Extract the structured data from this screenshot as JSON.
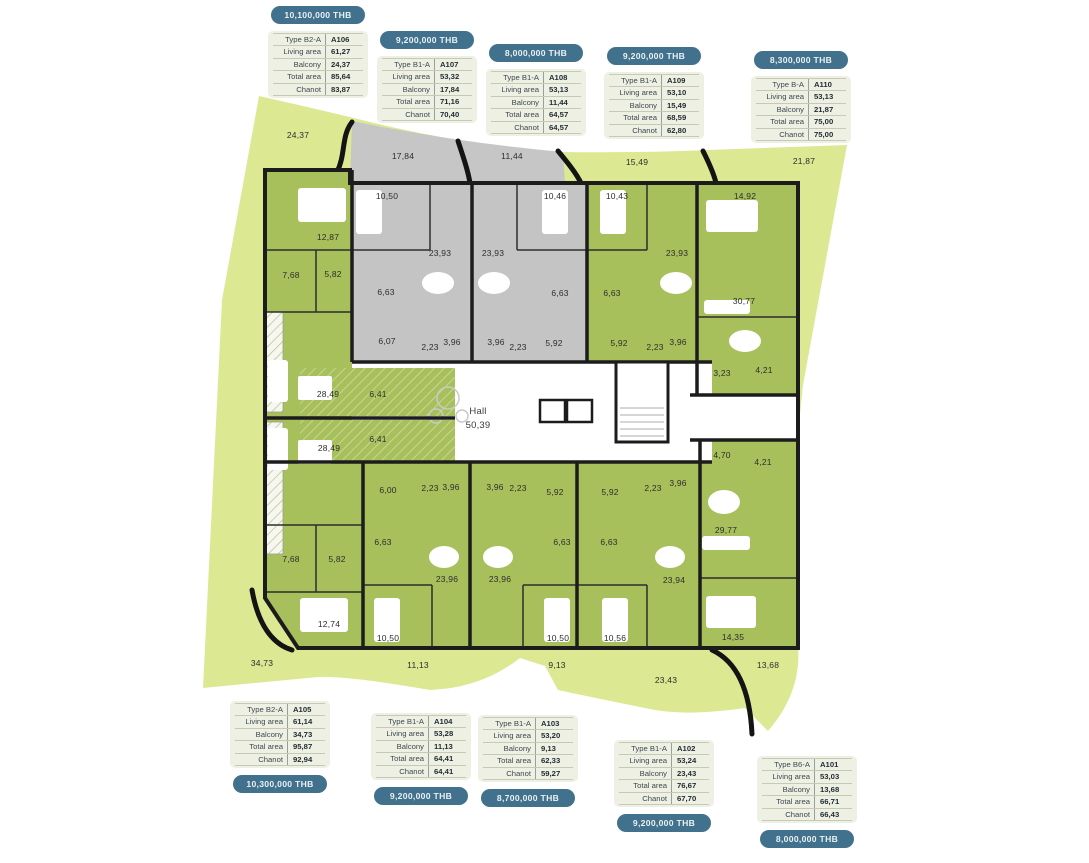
{
  "colors": {
    "terrace_green": "#dde893",
    "terrace_gray": "#c6c6c6",
    "unit_green": "#a8c05c",
    "unit_gray": "#c4c4c4",
    "wall": "#1c1c1c",
    "badge": "#41718c",
    "card_bg": "#eef0e3"
  },
  "plan": {
    "hall": {
      "name": "Hall",
      "area": "50,39"
    },
    "labels": [
      {
        "x": 298,
        "y": 138,
        "t": "24,37"
      },
      {
        "x": 403,
        "y": 159,
        "t": "17,84"
      },
      {
        "x": 512,
        "y": 159,
        "t": "11,44"
      },
      {
        "x": 637,
        "y": 165,
        "t": "15,49"
      },
      {
        "x": 804,
        "y": 164,
        "t": "21,87"
      },
      {
        "x": 262,
        "y": 666,
        "t": "34,73"
      },
      {
        "x": 418,
        "y": 668,
        "t": "11,13"
      },
      {
        "x": 557,
        "y": 668,
        "t": "9,13"
      },
      {
        "x": 666,
        "y": 683,
        "t": "23,43"
      },
      {
        "x": 768,
        "y": 668,
        "t": "13,68"
      },
      {
        "x": 328,
        "y": 240,
        "t": "12,87"
      },
      {
        "x": 291,
        "y": 278,
        "t": "7,68"
      },
      {
        "x": 333,
        "y": 277,
        "t": "5,82"
      },
      {
        "x": 328,
        "y": 397,
        "t": "28,49"
      },
      {
        "x": 378,
        "y": 397,
        "t": "6,41"
      },
      {
        "x": 387,
        "y": 199,
        "t": "10,50"
      },
      {
        "x": 440,
        "y": 256,
        "t": "23,93"
      },
      {
        "x": 386,
        "y": 295,
        "t": "6,63"
      },
      {
        "x": 387,
        "y": 344,
        "t": "6,07"
      },
      {
        "x": 430,
        "y": 350,
        "t": "2,23"
      },
      {
        "x": 452,
        "y": 345,
        "t": "3,96"
      },
      {
        "x": 555,
        "y": 199,
        "t": "10,46"
      },
      {
        "x": 493,
        "y": 256,
        "t": "23,93"
      },
      {
        "x": 560,
        "y": 296,
        "t": "6,63"
      },
      {
        "x": 554,
        "y": 346,
        "t": "5,92"
      },
      {
        "x": 518,
        "y": 350,
        "t": "2,23"
      },
      {
        "x": 496,
        "y": 345,
        "t": "3,96"
      },
      {
        "x": 617,
        "y": 199,
        "t": "10,43"
      },
      {
        "x": 677,
        "y": 256,
        "t": "23,93"
      },
      {
        "x": 612,
        "y": 296,
        "t": "6,63"
      },
      {
        "x": 619,
        "y": 346,
        "t": "5,92"
      },
      {
        "x": 655,
        "y": 350,
        "t": "2,23"
      },
      {
        "x": 678,
        "y": 345,
        "t": "3,96"
      },
      {
        "x": 745,
        "y": 199,
        "t": "14,92"
      },
      {
        "x": 744,
        "y": 304,
        "t": "30,77"
      },
      {
        "x": 722,
        "y": 376,
        "t": "3,23"
      },
      {
        "x": 764,
        "y": 373,
        "t": "4,21"
      },
      {
        "x": 478,
        "y": 414,
        "t": "Hall",
        "cls": "hall"
      },
      {
        "x": 478,
        "y": 428,
        "t": "50,39",
        "cls": "hall"
      },
      {
        "x": 378,
        "y": 442,
        "t": "6,41"
      },
      {
        "x": 722,
        "y": 458,
        "t": "4,70"
      },
      {
        "x": 763,
        "y": 465,
        "t": "4,21"
      },
      {
        "x": 329,
        "y": 451,
        "t": "28,49"
      },
      {
        "x": 291,
        "y": 562,
        "t": "7,68"
      },
      {
        "x": 337,
        "y": 562,
        "t": "5,82"
      },
      {
        "x": 329,
        "y": 627,
        "t": "12,74"
      },
      {
        "x": 388,
        "y": 493,
        "t": "6,00"
      },
      {
        "x": 430,
        "y": 491,
        "t": "2,23"
      },
      {
        "x": 451,
        "y": 490,
        "t": "3,96"
      },
      {
        "x": 383,
        "y": 545,
        "t": "6,63"
      },
      {
        "x": 447,
        "y": 582,
        "t": "23,96"
      },
      {
        "x": 388,
        "y": 641,
        "t": "10,50"
      },
      {
        "x": 495,
        "y": 490,
        "t": "3,96"
      },
      {
        "x": 518,
        "y": 491,
        "t": "2,23"
      },
      {
        "x": 555,
        "y": 495,
        "t": "5,92"
      },
      {
        "x": 562,
        "y": 545,
        "t": "6,63"
      },
      {
        "x": 500,
        "y": 582,
        "t": "23,96"
      },
      {
        "x": 558,
        "y": 641,
        "t": "10,50"
      },
      {
        "x": 610,
        "y": 495,
        "t": "5,92"
      },
      {
        "x": 653,
        "y": 491,
        "t": "2,23"
      },
      {
        "x": 678,
        "y": 486,
        "t": "3,96"
      },
      {
        "x": 609,
        "y": 545,
        "t": "6,63"
      },
      {
        "x": 674,
        "y": 583,
        "t": "23,94"
      },
      {
        "x": 615,
        "y": 641,
        "t": "10,56"
      },
      {
        "x": 726,
        "y": 533,
        "t": "29,77"
      },
      {
        "x": 733,
        "y": 640,
        "t": "14,35"
      }
    ]
  },
  "unit_cards": [
    {
      "id": "A106",
      "price": "10,100,000 THB",
      "badge": "top",
      "x": 268,
      "y": 6,
      "rows": [
        [
          "Type B2-A",
          "A106"
        ],
        [
          "Living area",
          "61,27"
        ],
        [
          "Balcony",
          "24,37"
        ],
        [
          "Total area",
          "85,64"
        ],
        [
          "Chanot",
          "83,87"
        ]
      ]
    },
    {
      "id": "A107",
      "price": "9,200,000 THB",
      "badge": "top",
      "x": 377,
      "y": 31,
      "rows": [
        [
          "Type B1-A",
          "A107"
        ],
        [
          "Living area",
          "53,32"
        ],
        [
          "Balcony",
          "17,84"
        ],
        [
          "Total area",
          "71,16"
        ],
        [
          "Chanot",
          "70,40"
        ]
      ]
    },
    {
      "id": "A108",
      "price": "8,000,000 THB",
      "badge": "top",
      "x": 486,
      "y": 44,
      "rows": [
        [
          "Type B1-A",
          "A108"
        ],
        [
          "Living area",
          "53,13"
        ],
        [
          "Balcony",
          "11,44"
        ],
        [
          "Total area",
          "64,57"
        ],
        [
          "Chanot",
          "64,57"
        ]
      ]
    },
    {
      "id": "A109",
      "price": "9,200,000 THB",
      "badge": "top",
      "x": 604,
      "y": 47,
      "rows": [
        [
          "Type B1-A",
          "A109"
        ],
        [
          "Living area",
          "53,10"
        ],
        [
          "Balcony",
          "15,49"
        ],
        [
          "Total area",
          "68,59"
        ],
        [
          "Chanot",
          "62,80"
        ]
      ]
    },
    {
      "id": "A110",
      "price": "8,300,000 THB",
      "badge": "top",
      "x": 751,
      "y": 51,
      "rows": [
        [
          "Type B-A",
          "A110"
        ],
        [
          "Living area",
          "53,13"
        ],
        [
          "Balcony",
          "21,87"
        ],
        [
          "Total area",
          "75,00"
        ],
        [
          "Chanot",
          "75,00"
        ]
      ]
    },
    {
      "id": "A105",
      "price": "10,300,000 THB",
      "badge": "bottom",
      "x": 230,
      "y": 701,
      "rows": [
        [
          "Type B2-A",
          "A105"
        ],
        [
          "Living area",
          "61,14"
        ],
        [
          "Balcony",
          "34,73"
        ],
        [
          "Total area",
          "95,87"
        ],
        [
          "Chanot",
          "92,94"
        ]
      ]
    },
    {
      "id": "A104",
      "price": "9,200,000 THB",
      "badge": "bottom",
      "x": 371,
      "y": 713,
      "rows": [
        [
          "Type B1-A",
          "A104"
        ],
        [
          "Living area",
          "53,28"
        ],
        [
          "Balcony",
          "11,13"
        ],
        [
          "Total area",
          "64,41"
        ],
        [
          "Chanot",
          "64,41"
        ]
      ]
    },
    {
      "id": "A103",
      "price": "8,700,000 THB",
      "badge": "bottom",
      "x": 478,
      "y": 715,
      "rows": [
        [
          "Type B1-A",
          "A103"
        ],
        [
          "Living area",
          "53,20"
        ],
        [
          "Balcony",
          "9,13"
        ],
        [
          "Total area",
          "62,33"
        ],
        [
          "Chanot",
          "59,27"
        ]
      ]
    },
    {
      "id": "A102",
      "price": "9,200,000 THB",
      "badge": "bottom",
      "x": 614,
      "y": 740,
      "rows": [
        [
          "Type B1-A",
          "A102"
        ],
        [
          "Living area",
          "53,24"
        ],
        [
          "Balcony",
          "23,43"
        ],
        [
          "Total area",
          "76,67"
        ],
        [
          "Chanot",
          "67,70"
        ]
      ]
    },
    {
      "id": "A101",
      "price": "8,000,000 THB",
      "badge": "bottom",
      "x": 757,
      "y": 756,
      "rows": [
        [
          "Type B6-A",
          "A101"
        ],
        [
          "Living area",
          "53,03"
        ],
        [
          "Balcony",
          "13,68"
        ],
        [
          "Total area",
          "66,71"
        ],
        [
          "Chanot",
          "66,43"
        ]
      ]
    }
  ]
}
